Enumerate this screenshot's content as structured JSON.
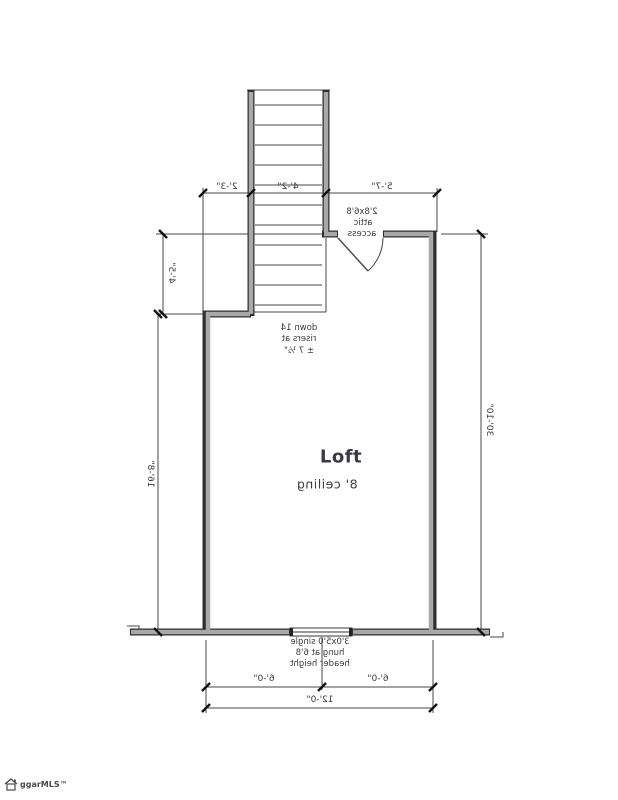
{
  "plan": {
    "room": {
      "name": "Loft",
      "ceiling": "8' ceiling"
    },
    "dimensions": {
      "top": [
        "2'-3\"",
        "4'-2\"",
        "5'-7\""
      ],
      "left_upper": "4'-5\"",
      "left": "16'-8\"",
      "right": "30'-10\"",
      "bottom_left_half": "6'-0\"",
      "bottom_right_half": "6'-0\"",
      "bottom_total": "12'-0\""
    },
    "notes": {
      "attic": [
        "2'8x6'8",
        "attic",
        "access"
      ],
      "stairs": [
        "down 14",
        "risers at",
        "± 7 ½\""
      ],
      "window": [
        "3'0x5'0 single",
        "hung at 6'8",
        "header height"
      ]
    }
  },
  "watermark": {
    "brand": "ggarMLS™",
    "icon": "house-icon"
  },
  "colors": {
    "background": "#ffffff",
    "thin_line": "#474747",
    "wall_edge": "#2f2f2f",
    "wall_fill": "#a8a8a8",
    "text": "#3a3a3a"
  }
}
